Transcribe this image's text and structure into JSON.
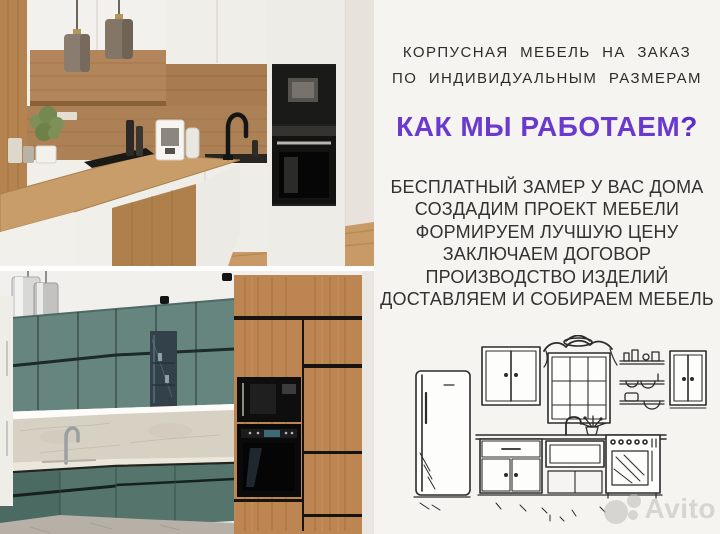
{
  "header": {
    "line1": "КОРПУСНАЯ  МЕБЕЛЬ  НА  ЗАКАЗ",
    "line2": "ПО  ИНДИВИДУАЛЬНЫМ  РАЗМЕРАМ"
  },
  "heading": {
    "text": "КАК МЫ РАБОТАЕМ",
    "question_mark": "?"
  },
  "steps": {
    "items": [
      "БЕСПЛАТНЫЙ ЗАМЕР У ВАС ДОМА",
      "СОЗДАДИМ ПРОЕКТ МЕБЕЛИ",
      "ФОРМИРУЕМ ЛУЧШУЮ ЦЕНУ",
      "ЗАКЛЮЧАЕМ ДОГОВОР",
      "ПРОИЗВОДСТВО ИЗДЕЛИЙ",
      "ДОСТАВЛЯЕМ И СОБИРАЕМ МЕБЕЛЬ"
    ]
  },
  "photos": {
    "top_alt": "White and oak kitchen with black built-in microwave and oven, two pendant lamps",
    "bottom_alt": "Teal green kitchen with tall oak cabinet column and black built-in appliances"
  },
  "sketch_alt": "Hand-drawn kitchen sketch: fridge, wall cabinets, window with valance, open shelves with dishes, sink and stove",
  "watermark": {
    "text": "Avito",
    "logo": "avito-circles-icon"
  },
  "colors": {
    "panel_bg": "#f6f4f0",
    "accent_purple": "#6a3ace",
    "text_dark": "#333230",
    "teal_cabinets": "#5a7a72",
    "wood": "#bc8551",
    "watermark_gray": "#bfbdba"
  }
}
